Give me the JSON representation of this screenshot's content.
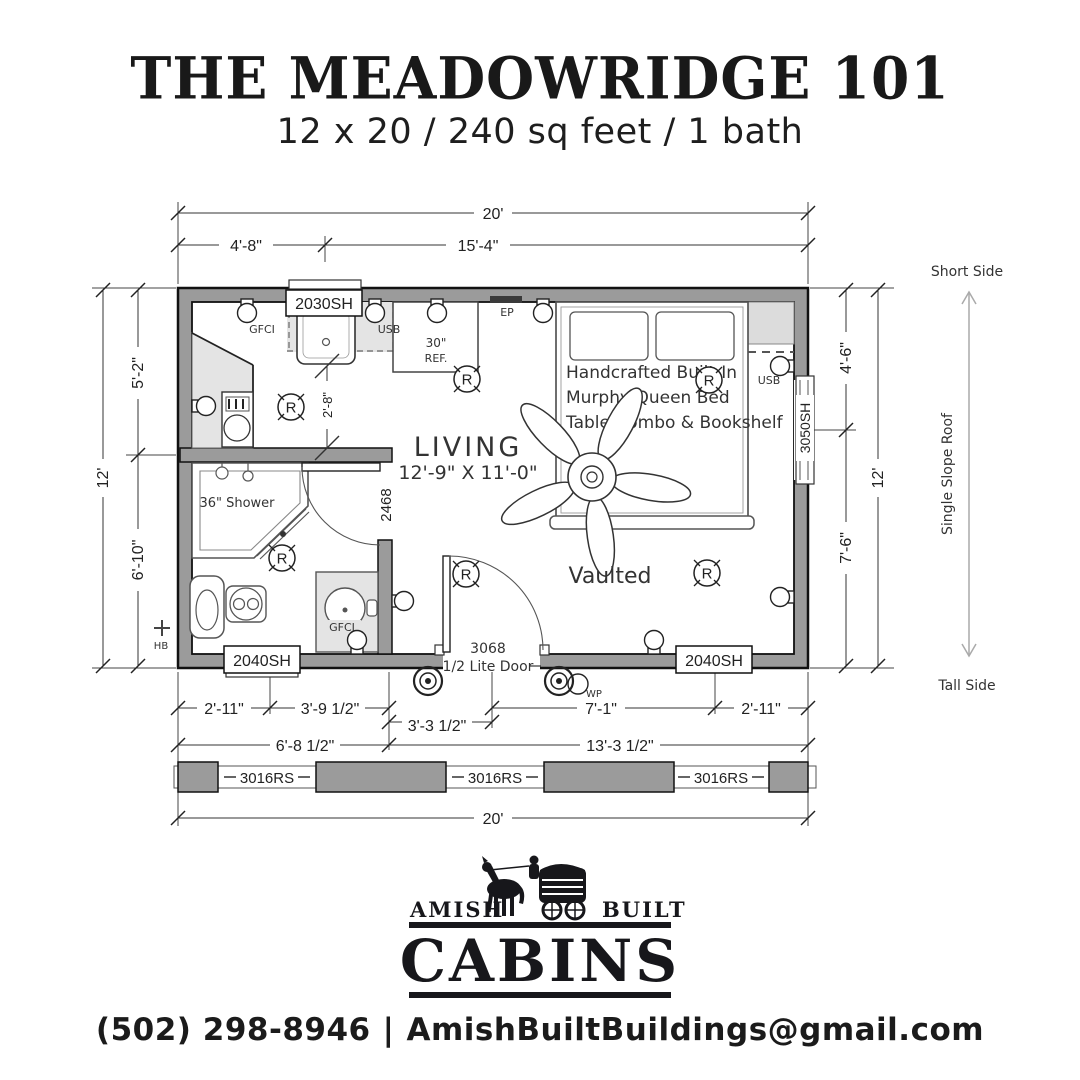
{
  "header": {
    "title": "THE MEADOWRIDGE 101",
    "subtitle": "12 x 20 / 240 sq feet / 1 bath"
  },
  "plan": {
    "dims": {
      "top_overall": "20'",
      "top_left": "4'-8\"",
      "top_right": "15'-4\"",
      "left_overall": "12'",
      "left_top": "5'-2\"",
      "left_bottom": "6'-10\"",
      "right_overall": "12'",
      "right_top": "4'-6\"",
      "right_bottom": "7'-6\"",
      "bottom_r1": [
        "2'-11\"",
        "3'-9 1/2\"",
        "3'-3 1/2\"",
        "7'-1\"",
        "2'-11\""
      ],
      "bottom_r2_left": "6'-8 1/2\"",
      "bottom_r2_right": "13'-3 1/2\"",
      "bottom_overall": "20'",
      "aisle": "2'-8\""
    },
    "windows": {
      "top": "2030SH",
      "right": "3050SH",
      "bath": "2040SH",
      "living": "2040SH",
      "strip": [
        "3016RS",
        "3016RS",
        "3016RS"
      ]
    },
    "doors": {
      "bath": "2468",
      "entry_size": "3068",
      "entry_type": "1/2 Lite Door"
    },
    "rooms": {
      "living": "LIVING",
      "living_size": "12'-9\" X 11'-0\"",
      "vaulted": "Vaulted",
      "shower": "36\" Shower"
    },
    "bed_note": [
      "Handcrafted Built-In",
      "Murphy Queen Bed",
      "Table Combo & Bookshelf"
    ],
    "appliances": {
      "ref_l1": "30\"",
      "ref_l2": "REF."
    },
    "electrical": {
      "gfci_kitchen": "GFCI",
      "usb_kitchen": "USB",
      "ep": "EP",
      "usb_bed": "USB",
      "gfci_bath": "GFCI",
      "wp": "WP",
      "hb": "HB",
      "recessed": "R"
    },
    "roof": {
      "short_side": "Short Side",
      "slope": "Single Slope Roof",
      "tall_side": "Tall Side"
    }
  },
  "logo": {
    "amish": "AMISH",
    "built": "BUILT",
    "cabins": "CABINS"
  },
  "contact": {
    "phone": "(502) 298-8946",
    "separator": "|",
    "email": "AmishBuiltBuildings@gmail.com"
  }
}
